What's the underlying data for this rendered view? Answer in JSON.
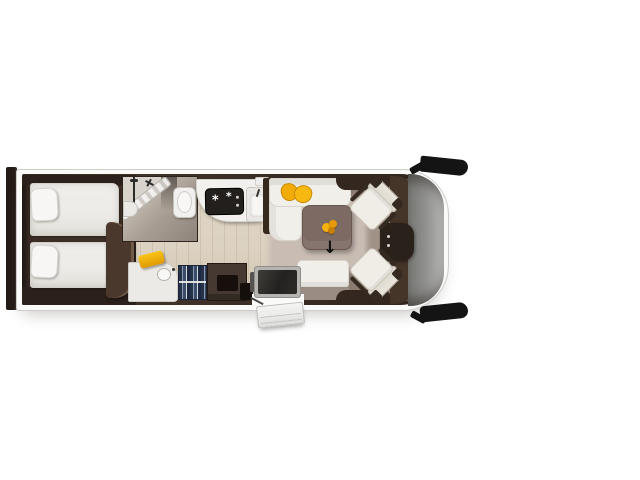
{
  "meta": {
    "title": "Motorhome floor plan — top-down view",
    "view": "top-down floor plan, front cab on the right, bedroom at the rear left"
  },
  "glyphs": {
    "arrow_down": "↓",
    "burner": "*"
  },
  "colors": {
    "page_bg": "#ffffff",
    "body_fill": "#fafaf9",
    "body_stroke": "#cccccb",
    "bumper": "#241c16",
    "wall_dark": "#32271f",
    "wall_mid": "#42332a",
    "platform": "#3e2f26",
    "platform_dark": "#2c211a",
    "bed_white": "#edebe7",
    "pillow_white": "#f7f6f4",
    "wood": "#dcd2c1",
    "mat": "#c8bcb3",
    "bath_dark": "#8e8378",
    "glass_white": "#f4f3f1",
    "toilet_white": "#f1f0ee",
    "counter_white": "#f2f1ed",
    "hob_black": "#221f1d",
    "sofa_white": "#f1efe9",
    "yellow": "#f2ac08",
    "yellow_deep": "#e09a04",
    "table_brown": "#7d6a63",
    "table_edge": "#695750",
    "bench_base": "#9a8c83",
    "vanity_white": "#eceae6",
    "clothes_navy": "#26324a",
    "cabinet_brown": "#463931",
    "cabinet_inner": "#170f0b",
    "tv_frame": "#b6b4b0",
    "tv_screen": "#232220",
    "cab_floor": "#8a7a70",
    "cab_mat": "#a4958a",
    "seat_white": "#f0ede7",
    "seat_trim": "#352a21",
    "dash_brown": "#453428",
    "console_dark": "#2a211b",
    "glass_gray_1": "#757572",
    "glass_gray_2": "#b4b4b2",
    "mirror_black": "#141414",
    "step_light": "#ededeb",
    "step_edge": "#bdbdbb",
    "arrow_black": "#0d0d0d"
  },
  "legend": {
    "rear_bumper": "rear bumper bar",
    "twin_beds": "two single beds with pillows",
    "shower": "corner shower with diagonal glass door",
    "toilet": "toilet",
    "kitchen_hob": "hob with burners",
    "kitchen_sink": "kitchen sink with tap",
    "l_sofa": "L-shaped lounge sofa",
    "sofa_cushions": "two yellow scatter cushions",
    "lounge_table": "lounge table with yellow centrepiece",
    "entrance_arrow": "entrance direction arrow",
    "bench_seat": "forward-facing travel bench",
    "washroom_vanity": "washroom vanity with basin and yellow towel",
    "wardrobe": "wardrobe with hanging clothes",
    "tv_unit": "TV sideboard at entrance door",
    "cab_seats": "two swivelled cab seats",
    "dashboard": "dashboard console with steering wheel",
    "windscreen": "curved front windscreen",
    "wing_mirrors": "black wing mirrors",
    "entry_step": "external entry step"
  }
}
